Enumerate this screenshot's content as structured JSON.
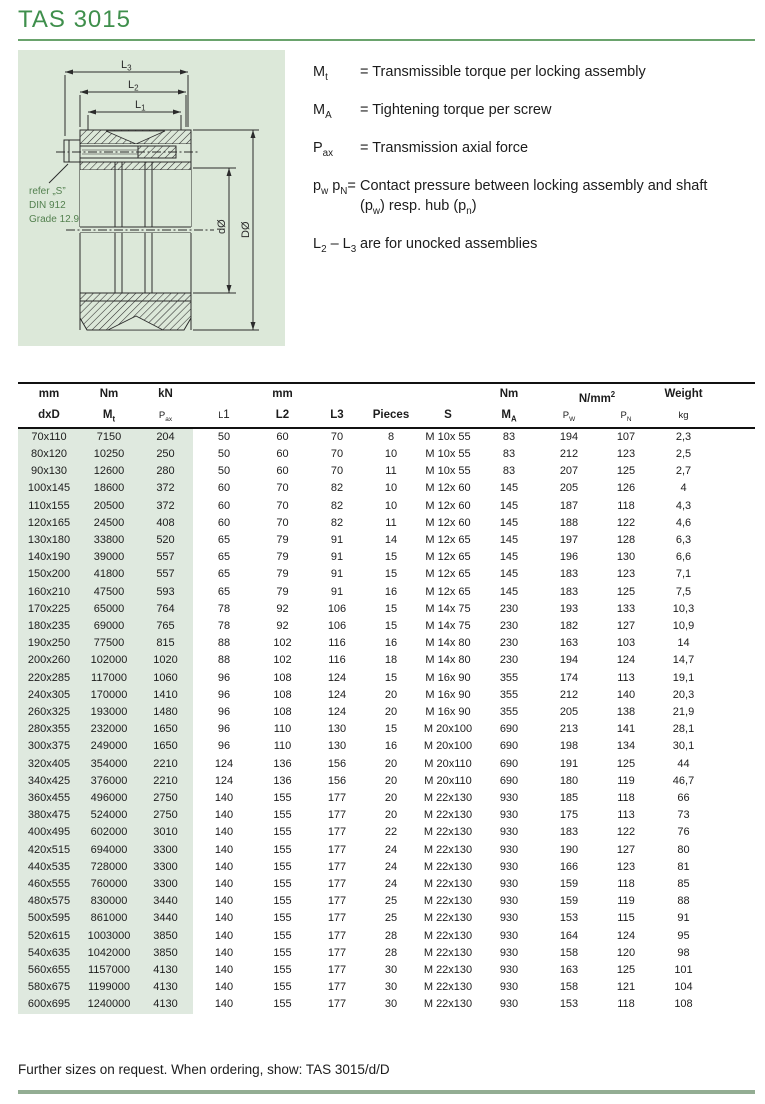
{
  "page": {
    "title": "TAS 3015",
    "footer_note": "Further sizes on request. When ordering, show: TAS 3015/d/D"
  },
  "colors": {
    "title_green": "#3f8f4c",
    "title_rule_green": "#6aa36d",
    "diagram_panel_green": "#dce8d9",
    "table_shade_green": "#dfe9df",
    "footer_rule_green": "#93ad93"
  },
  "diagram": {
    "dims": {
      "l1": {
        "base": "L",
        "sub": "1"
      },
      "l2": {
        "base": "L",
        "sub": "2"
      },
      "l3": {
        "base": "L",
        "sub": "3"
      }
    },
    "d_label": "dØ",
    "D_label": "DØ",
    "screw_note": [
      "refer „S”",
      "DIN 912",
      "Grade 12.9"
    ]
  },
  "legend": {
    "items": [
      {
        "sym": [
          {
            "t": "M"
          },
          {
            "t": "t",
            "st": "sub"
          }
        ],
        "lines": [
          [
            {
              "t": "= Transmissible torque per locking assembly"
            }
          ]
        ]
      },
      {
        "sym": [
          {
            "t": "M"
          },
          {
            "t": "A",
            "st": "sub"
          }
        ],
        "lines": [
          [
            {
              "t": "= Tightening torque per screw"
            }
          ]
        ]
      },
      {
        "sym": [
          {
            "t": "P"
          },
          {
            "t": "ax",
            "st": "sub"
          }
        ],
        "lines": [
          [
            {
              "t": "= Transmission axial force"
            }
          ]
        ]
      },
      {
        "sym": [
          {
            "t": "p"
          },
          {
            "t": "w",
            "st": "sub"
          },
          {
            "t": " p"
          },
          {
            "t": "N",
            "st": "sub"
          },
          {
            "t": "="
          }
        ],
        "lines": [
          [
            {
              "t": "Contact pressure between locking assembly and shaft"
            }
          ],
          [
            {
              "t": "(p"
            },
            {
              "t": "w",
              "st": "sub"
            },
            {
              "t": ") resp. hub (p"
            },
            {
              "t": "n",
              "st": "sub"
            },
            {
              "t": ")"
            }
          ]
        ]
      },
      {
        "sym": [
          {
            "t": "L"
          },
          {
            "t": "2",
            "st": "sub"
          },
          {
            "t": " – L"
          },
          {
            "t": "3",
            "st": "sub"
          }
        ],
        "lines": [
          [
            {
              "t": "are for unocked assemblies"
            }
          ]
        ]
      }
    ]
  },
  "table": {
    "unit_cells": [
      {
        "col": 1,
        "parts": [
          {
            "t": "mm"
          }
        ]
      },
      {
        "col": 2,
        "parts": [
          {
            "t": "Nm"
          }
        ]
      },
      {
        "col": 3,
        "parts": [
          {
            "t": "kN"
          }
        ]
      },
      {
        "col": 5,
        "parts": [
          {
            "t": "mm"
          }
        ]
      },
      {
        "col": 9,
        "parts": [
          {
            "t": "Nm"
          }
        ]
      },
      {
        "col": 10,
        "span": 2,
        "parts": [
          {
            "t": "N/mm"
          },
          {
            "t": "2",
            "st": "sup"
          }
        ]
      },
      {
        "col": 12,
        "parts": [
          {
            "t": "Weight"
          }
        ]
      }
    ],
    "header_cells": [
      {
        "key": "dxd",
        "parts": [
          {
            "t": "dxD"
          }
        ]
      },
      {
        "key": "mt",
        "parts": [
          {
            "t": "M"
          },
          {
            "t": "t",
            "st": "sub"
          }
        ]
      },
      {
        "key": "pax",
        "cls": "smh",
        "parts": [
          {
            "t": "P"
          },
          {
            "t": "ax",
            "st": "sub"
          }
        ]
      },
      {
        "key": "l1",
        "cls": "l1h",
        "parts": [
          {
            "t": "L",
            "st": "sm"
          },
          {
            "t": "1"
          }
        ]
      },
      {
        "key": "l2",
        "parts": [
          {
            "t": "L2"
          }
        ]
      },
      {
        "key": "l3",
        "parts": [
          {
            "t": "L3"
          }
        ]
      },
      {
        "key": "pieces",
        "parts": [
          {
            "t": "Pieces"
          }
        ]
      },
      {
        "key": "s",
        "parts": [
          {
            "t": "S"
          }
        ]
      },
      {
        "key": "ma",
        "parts": [
          {
            "t": "M"
          },
          {
            "t": "A",
            "st": "sub"
          }
        ]
      },
      {
        "key": "pw",
        "cls": "smh",
        "parts": [
          {
            "t": "P"
          },
          {
            "t": "W",
            "st": "sub"
          }
        ]
      },
      {
        "key": "pn",
        "cls": "smh",
        "parts": [
          {
            "t": "P"
          },
          {
            "t": "N",
            "st": "sub"
          }
        ]
      },
      {
        "key": "kg",
        "cls": "smh",
        "parts": [
          {
            "t": "kg"
          }
        ]
      }
    ],
    "col_keys": [
      "dxd",
      "mt",
      "pax",
      "l1",
      "l2",
      "l3",
      "pieces",
      "s",
      "ma",
      "pw",
      "pn",
      "weight"
    ],
    "rows": [
      [
        "70x110",
        "7150",
        "204",
        "50",
        "60",
        "70",
        "8",
        "M 10x 55",
        "83",
        "194",
        "107",
        "2,3"
      ],
      [
        "80x120",
        "10250",
        "250",
        "50",
        "60",
        "70",
        "10",
        "M 10x 55",
        "83",
        "212",
        "123",
        "2,5"
      ],
      [
        "90x130",
        "12600",
        "280",
        "50",
        "60",
        "70",
        "11",
        "M 10x 55",
        "83",
        "207",
        "125",
        "2,7"
      ],
      [
        "100x145",
        "18600",
        "372",
        "60",
        "70",
        "82",
        "10",
        "M 12x 60",
        "145",
        "205",
        "126",
        "4"
      ],
      [
        "110x155",
        "20500",
        "372",
        "60",
        "70",
        "82",
        "10",
        "M 12x 60",
        "145",
        "187",
        "118",
        "4,3"
      ],
      [
        "120x165",
        "24500",
        "408",
        "60",
        "70",
        "82",
        "11",
        "M 12x 60",
        "145",
        "188",
        "122",
        "4,6"
      ],
      [
        "130x180",
        "33800",
        "520",
        "65",
        "79",
        "91",
        "14",
        "M 12x 65",
        "145",
        "197",
        "128",
        "6,3"
      ],
      [
        "140x190",
        "39000",
        "557",
        "65",
        "79",
        "91",
        "15",
        "M 12x 65",
        "145",
        "196",
        "130",
        "6,6"
      ],
      [
        "150x200",
        "41800",
        "557",
        "65",
        "79",
        "91",
        "15",
        "M 12x 65",
        "145",
        "183",
        "123",
        "7,1"
      ],
      [
        "160x210",
        "47500",
        "593",
        "65",
        "79",
        "91",
        "16",
        "M 12x 65",
        "145",
        "183",
        "125",
        "7,5"
      ],
      [
        "170x225",
        "65000",
        "764",
        "78",
        "92",
        "106",
        "15",
        "M 14x 75",
        "230",
        "193",
        "133",
        "10,3"
      ],
      [
        "180x235",
        "69000",
        "765",
        "78",
        "92",
        "106",
        "15",
        "M 14x 75",
        "230",
        "182",
        "127",
        "10,9"
      ],
      [
        "190x250",
        "77500",
        "815",
        "88",
        "102",
        "116",
        "16",
        "M 14x 80",
        "230",
        "163",
        "103",
        "14"
      ],
      [
        "200x260",
        "102000",
        "1020",
        "88",
        "102",
        "116",
        "18",
        "M 14x 80",
        "230",
        "194",
        "124",
        "14,7"
      ],
      [
        "220x285",
        "117000",
        "1060",
        "96",
        "108",
        "124",
        "15",
        "M 16x 90",
        "355",
        "174",
        "113",
        "19,1"
      ],
      [
        "240x305",
        "170000",
        "1410",
        "96",
        "108",
        "124",
        "20",
        "M 16x 90",
        "355",
        "212",
        "140",
        "20,3"
      ],
      [
        "260x325",
        "193000",
        "1480",
        "96",
        "108",
        "124",
        "20",
        "M 16x 90",
        "355",
        "205",
        "138",
        "21,9"
      ],
      [
        "280x355",
        "232000",
        "1650",
        "96",
        "110",
        "130",
        "15",
        "M 20x100",
        "690",
        "213",
        "141",
        "28,1"
      ],
      [
        "300x375",
        "249000",
        "1650",
        "96",
        "110",
        "130",
        "16",
        "M 20x100",
        "690",
        "198",
        "134",
        "30,1"
      ],
      [
        "320x405",
        "354000",
        "2210",
        "124",
        "136",
        "156",
        "20",
        "M 20x110",
        "690",
        "191",
        "125",
        "44"
      ],
      [
        "340x425",
        "376000",
        "2210",
        "124",
        "136",
        "156",
        "20",
        "M 20x110",
        "690",
        "180",
        "119",
        "46,7"
      ],
      [
        "360x455",
        "496000",
        "2750",
        "140",
        "155",
        "177",
        "20",
        "M 22x130",
        "930",
        "185",
        "118",
        "66"
      ],
      [
        "380x475",
        "524000",
        "2750",
        "140",
        "155",
        "177",
        "20",
        "M 22x130",
        "930",
        "175",
        "113",
        "73"
      ],
      [
        "400x495",
        "602000",
        "3010",
        "140",
        "155",
        "177",
        "22",
        "M 22x130",
        "930",
        "183",
        "122",
        "76"
      ],
      [
        "420x515",
        "694000",
        "3300",
        "140",
        "155",
        "177",
        "24",
        "M 22x130",
        "930",
        "190",
        "127",
        "80"
      ],
      [
        "440x535",
        "728000",
        "3300",
        "140",
        "155",
        "177",
        "24",
        "M 22x130",
        "930",
        "166",
        "123",
        "81"
      ],
      [
        "460x555",
        "760000",
        "3300",
        "140",
        "155",
        "177",
        "24",
        "M 22x130",
        "930",
        "159",
        "118",
        "85"
      ],
      [
        "480x575",
        "830000",
        "3440",
        "140",
        "155",
        "177",
        "25",
        "M 22x130",
        "930",
        "159",
        "119",
        "88"
      ],
      [
        "500x595",
        "861000",
        "3440",
        "140",
        "155",
        "177",
        "25",
        "M 22x130",
        "930",
        "153",
        "115",
        "91"
      ],
      [
        "520x615",
        "1003000",
        "3850",
        "140",
        "155",
        "177",
        "28",
        "M 22x130",
        "930",
        "164",
        "124",
        "95"
      ],
      [
        "540x635",
        "1042000",
        "3850",
        "140",
        "155",
        "177",
        "28",
        "M 22x130",
        "930",
        "158",
        "120",
        "98"
      ],
      [
        "560x655",
        "1157000",
        "4130",
        "140",
        "155",
        "177",
        "30",
        "M 22x130",
        "930",
        "163",
        "125",
        "101"
      ],
      [
        "580x675",
        "1199000",
        "4130",
        "140",
        "155",
        "177",
        "30",
        "M 22x130",
        "930",
        "158",
        "121",
        "104"
      ],
      [
        "600x695",
        "1240000",
        "4130",
        "140",
        "155",
        "177",
        "30",
        "M 22x130",
        "930",
        "153",
        "118",
        "108"
      ]
    ]
  }
}
